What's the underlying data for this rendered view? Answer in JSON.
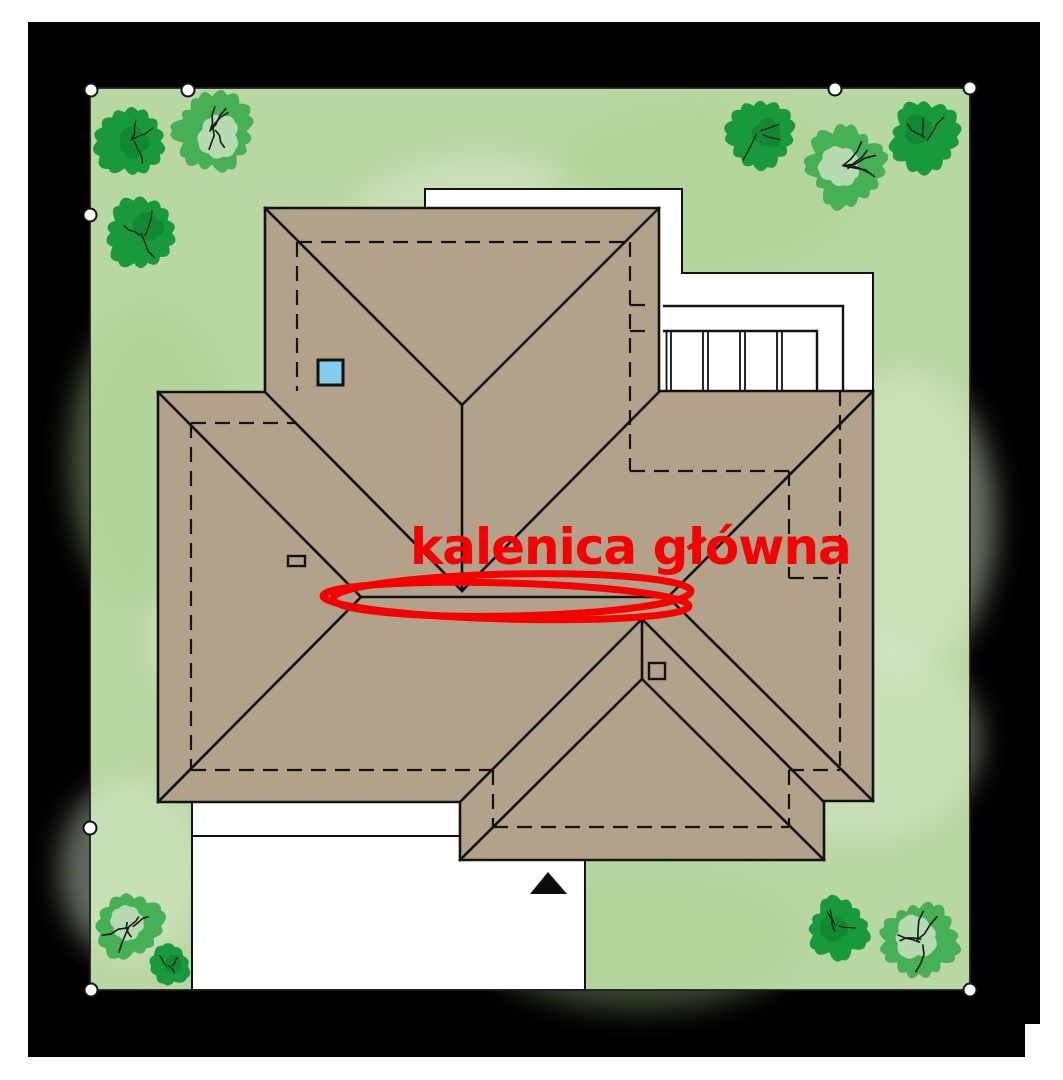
{
  "annotation": {
    "text": "kalenica główna",
    "color": "#f60000"
  },
  "colors": {
    "page": "#ffffff",
    "frame": "#000000",
    "lawn": "#b9d7a2",
    "lawn_light": "#dcead0",
    "lawn_shade": "#a9cf8e",
    "plot_line": "#1f1f1f",
    "roof": "#b3a28a",
    "line": "#121212",
    "white_area": "#ffffff",
    "skylight": "#85ccef",
    "tree_dark": "#189a3c",
    "tree_deep": "#0c7c2d",
    "tree_light": "#45b054",
    "branch": "#161616",
    "red": "#f60000"
  },
  "site": {
    "markers": [
      {
        "x": 91,
        "y": 90
      },
      {
        "x": 188,
        "y": 90
      },
      {
        "x": 835,
        "y": 89
      },
      {
        "x": 970,
        "y": 88
      },
      {
        "x": 90,
        "y": 215
      },
      {
        "x": 90,
        "y": 828
      },
      {
        "x": 91,
        "y": 990
      },
      {
        "x": 970,
        "y": 990
      }
    ],
    "trees": [
      {
        "x": 131,
        "y": 141,
        "r": 33,
        "variant": "dark"
      },
      {
        "x": 212,
        "y": 131,
        "r": 38,
        "variant": "light"
      },
      {
        "x": 141,
        "y": 233,
        "r": 34,
        "variant": "dark"
      },
      {
        "x": 760,
        "y": 134,
        "r": 33,
        "variant": "dark"
      },
      {
        "x": 846,
        "y": 166,
        "r": 39,
        "variant": "light"
      },
      {
        "x": 925,
        "y": 137,
        "r": 34,
        "variant": "dark"
      },
      {
        "x": 131,
        "y": 926,
        "r": 32,
        "variant": "light"
      },
      {
        "x": 169,
        "y": 966,
        "r": 20,
        "variant": "dark"
      },
      {
        "x": 838,
        "y": 929,
        "r": 30,
        "variant": "dark"
      },
      {
        "x": 919,
        "y": 941,
        "r": 38,
        "variant": "light"
      }
    ]
  }
}
